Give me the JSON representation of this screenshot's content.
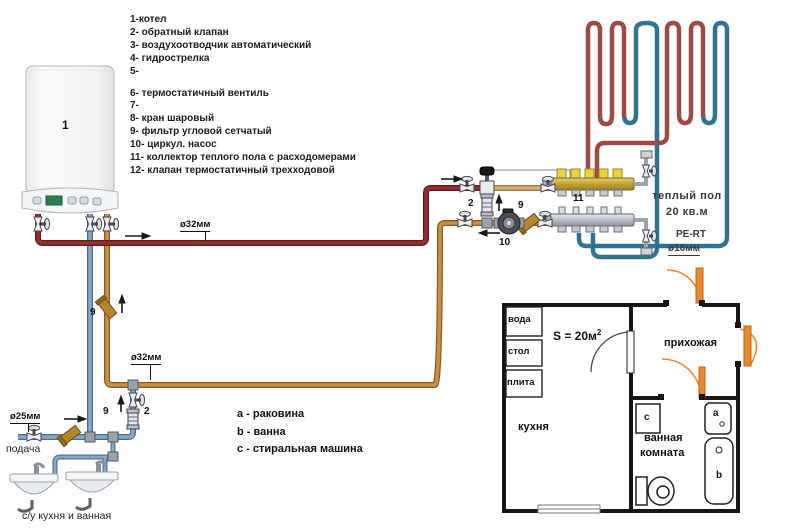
{
  "legend": {
    "items": [
      "1-котел",
      "2- обратный клапан",
      "3- воздухоотводчик автоматический",
      "4- гидрострелка",
      "5-",
      "6- термостатичный вентиль",
      "7-",
      "8- кран шаровый",
      "9- фильтр угловой сетчатый",
      "10- циркул. насос",
      "11- коллектор теплого пола с расходомерами",
      "12- клапан термостатичный  трехходовой"
    ]
  },
  "abc_legend": {
    "items": [
      "a - раковина",
      "b - ванна",
      "c - стиральная машина"
    ]
  },
  "diagram_labels": {
    "boiler_number": "1",
    "check_valve_top": "2",
    "filter_pump_line": "9",
    "pump_number": "10",
    "manifold_number": "11",
    "filter_return": "9",
    "filter_cold": "9",
    "check_valve_makeup": "2",
    "pipe_d32_top": "ø32мм",
    "pipe_d32_bottom": "ø32мм",
    "pipe_d25": "ø25мм",
    "supply_caption": "подача",
    "sinks_caption": "с/у кухня и  ванная",
    "floor_heating_line1": "теплый пол",
    "floor_heating_line2": "20 кв.м",
    "pipe_type": "PE-RT",
    "pipe_d16": "ø16мм"
  },
  "floor_plan": {
    "area_label": "S = 20м",
    "area_sup": "2",
    "kitchen": "кухня",
    "hallway": "прихожая",
    "bathroom_line1": "ванная",
    "bathroom_line2": "комната",
    "kitchen_items": [
      "вода",
      "стол",
      "плита"
    ],
    "marks": {
      "washer": "c",
      "sink": "a",
      "bath": "b"
    }
  },
  "colors": {
    "pipe_hot": "#8e2b28",
    "pipe_return": "#c08540",
    "pipe_tan": "#cfa76a",
    "pipe_cold": "#7094b5",
    "coil_supply": "#9c4a44",
    "coil_return": "#2f7391",
    "door": "#e8882a",
    "manifold_gold": "#caa83c"
  }
}
